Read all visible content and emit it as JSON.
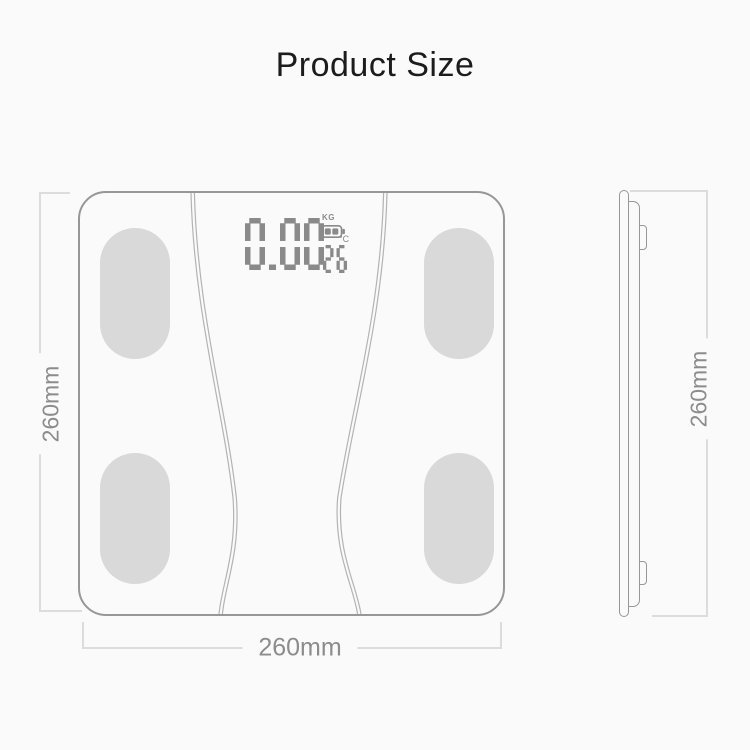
{
  "title": "Product Size",
  "colors": {
    "background": "#fafafa",
    "outline": "#979797",
    "pad_fill": "#d9d9d9",
    "lcd_segments": "#8a8a8a",
    "dimension_line": "#dcdcdc",
    "dimension_text": "#8c8c8c",
    "title_text": "#1c1c1c"
  },
  "front_view": {
    "display": {
      "weight": "0.00",
      "weight_unit": "KG",
      "temperature": "26",
      "temperature_unit": "°C",
      "battery_icon": "battery-two-bars"
    },
    "height_label": "260mm",
    "width_label": "260mm"
  },
  "side_view": {
    "height_label": "260mm"
  }
}
